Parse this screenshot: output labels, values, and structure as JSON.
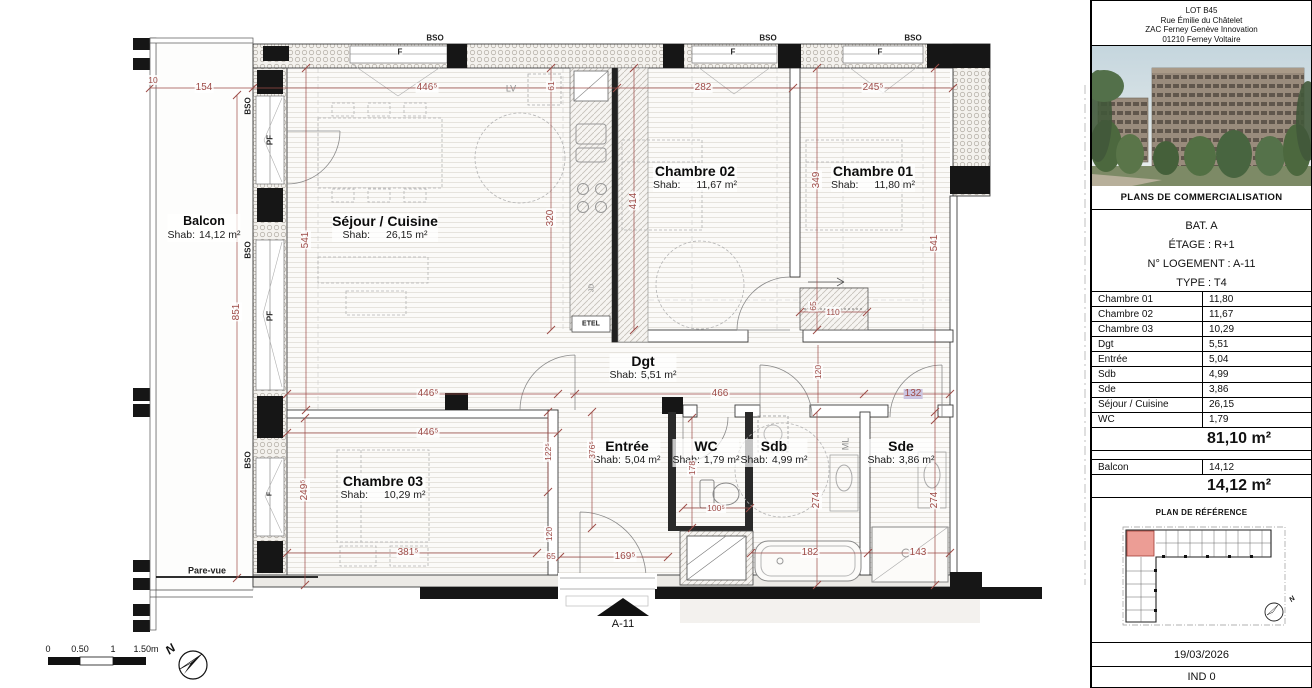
{
  "plan": {
    "shab_label": "Shab:",
    "rooms": [
      {
        "name": "Séjour / Cuisine",
        "area": "26,15 m²",
        "x": 385,
        "y": 214,
        "wide": true
      },
      {
        "name": "Chambre 02",
        "area": "11,67 m²",
        "x": 695,
        "y": 164,
        "wide": true
      },
      {
        "name": "Chambre 01",
        "area": "11,80 m²",
        "x": 873,
        "y": 164,
        "wide": true
      },
      {
        "name": "Chambre 03",
        "area": "10,29 m²",
        "x": 383,
        "y": 474,
        "wide": true
      },
      {
        "name": "Dgt",
        "area": "5,51 m²",
        "x": 643,
        "y": 354
      },
      {
        "name": "Entrée",
        "area": "5,04 m²",
        "x": 627,
        "y": 439
      },
      {
        "name": "WC",
        "area": "1,79 m²",
        "x": 706,
        "y": 439
      },
      {
        "name": "Sdb",
        "area": "4,99 m²",
        "x": 774,
        "y": 439
      },
      {
        "name": "Sde",
        "area": "3,86 m²",
        "x": 901,
        "y": 439
      },
      {
        "name": "Balcon",
        "area": "14,12 m²",
        "x": 204,
        "y": 214,
        "small": true
      }
    ],
    "dimensions": [
      {
        "t": "10",
        "x": 153,
        "y": 80,
        "s": 1
      },
      {
        "t": "154",
        "x": 204,
        "y": 88
      },
      {
        "t": "446⁵",
        "x": 427,
        "y": 88
      },
      {
        "t": "282",
        "x": 703,
        "y": 88
      },
      {
        "t": "245⁵",
        "x": 873,
        "y": 88
      },
      {
        "t": "851",
        "x": 237,
        "y": 312,
        "v": 1
      },
      {
        "t": "541",
        "x": 306,
        "y": 240,
        "v": 1
      },
      {
        "t": "541",
        "x": 935,
        "y": 243,
        "v": 1
      },
      {
        "t": "61",
        "x": 551,
        "y": 86,
        "v": 1,
        "s": 1
      },
      {
        "t": "320",
        "x": 551,
        "y": 218,
        "v": 1
      },
      {
        "t": "414",
        "x": 634,
        "y": 201,
        "v": 1
      },
      {
        "t": "349",
        "x": 817,
        "y": 180,
        "v": 1
      },
      {
        "t": "446⁵",
        "x": 428,
        "y": 394
      },
      {
        "t": "466",
        "x": 720,
        "y": 394
      },
      {
        "t": "132",
        "x": 913,
        "y": 394,
        "hl": 1
      },
      {
        "t": "446⁵",
        "x": 428,
        "y": 433
      },
      {
        "t": "122⁵",
        "x": 548,
        "y": 452,
        "v": 1,
        "s": 1
      },
      {
        "t": "376⁵",
        "x": 592,
        "y": 450,
        "v": 1,
        "s": 1
      },
      {
        "t": "178",
        "x": 692,
        "y": 468,
        "v": 1,
        "s": 1
      },
      {
        "t": "100⁵",
        "x": 716,
        "y": 508,
        "s": 1
      },
      {
        "t": "120",
        "x": 818,
        "y": 372,
        "v": 1,
        "s": 1
      },
      {
        "t": "110",
        "x": 833,
        "y": 312,
        "s": 1
      },
      {
        "t": "65",
        "x": 813,
        "y": 306,
        "v": 1,
        "s": 1
      },
      {
        "t": "274",
        "x": 817,
        "y": 500,
        "v": 1
      },
      {
        "t": "274",
        "x": 935,
        "y": 500,
        "v": 1
      },
      {
        "t": "120",
        "x": 549,
        "y": 534,
        "v": 1,
        "s": 1
      },
      {
        "t": "65",
        "x": 551,
        "y": 556,
        "s": 1
      },
      {
        "t": "169⁵",
        "x": 625,
        "y": 557
      },
      {
        "t": "182",
        "x": 810,
        "y": 553
      },
      {
        "t": "143",
        "x": 918,
        "y": 553
      },
      {
        "t": "381⁵",
        "x": 408,
        "y": 553
      },
      {
        "t": "249⁵",
        "x": 305,
        "y": 490,
        "v": 1
      }
    ],
    "annotations": [
      {
        "t": "BSO",
        "x": 435,
        "y": 38
      },
      {
        "t": "BSO",
        "x": 768,
        "y": 38
      },
      {
        "t": "BSO",
        "x": 913,
        "y": 38
      },
      {
        "t": "BSO",
        "x": 248,
        "y": 106,
        "v": 1
      },
      {
        "t": "BSO",
        "x": 248,
        "y": 250,
        "v": 1
      },
      {
        "t": "BSO",
        "x": 248,
        "y": 460,
        "v": 1
      },
      {
        "t": "F",
        "x": 400,
        "y": 52
      },
      {
        "t": "F",
        "x": 733,
        "y": 52
      },
      {
        "t": "F",
        "x": 880,
        "y": 52
      },
      {
        "t": "PF",
        "x": 270,
        "y": 140,
        "v": 1
      },
      {
        "t": "PF",
        "x": 270,
        "y": 316,
        "v": 1
      },
      {
        "t": "F",
        "x": 270,
        "y": 494,
        "v": 1,
        "s": 1
      },
      {
        "t": "LV",
        "x": 511,
        "y": 89,
        "gray": 1
      },
      {
        "t": "ETEL",
        "x": 591,
        "y": 324,
        "s": 1
      },
      {
        "t": "JD",
        "x": 592,
        "y": 288,
        "v": 1,
        "gray": 1,
        "s": 1
      },
      {
        "t": "ML",
        "x": 846,
        "y": 444,
        "v": 1,
        "gray": 1
      },
      {
        "t": "Pare-vue",
        "x": 207,
        "y": 571,
        "b": 1
      }
    ],
    "entry_marker": "A-11",
    "compass_label": "N",
    "scale_bar": {
      "labels": [
        {
          "t": "0",
          "x": 48
        },
        {
          "t": "0.50",
          "x": 80
        },
        {
          "t": "1",
          "x": 113
        },
        {
          "t": "1.50m",
          "x": 146
        }
      ]
    },
    "colors": {
      "dimension": "#9d4b47",
      "wall": "#161616",
      "highlight": "#cbc4e0",
      "ref_unit": "#ec9d95"
    }
  },
  "sidebar": {
    "header": {
      "line1": "LOT B45",
      "line2": "Rue Émilie du Châtelet",
      "line3": "ZAC Ferney Genève Innovation",
      "line4": "01210 Ferney Voltaire"
    },
    "caption": "PLANS DE COMMERCIALISATION",
    "info": {
      "bat": "BAT. A",
      "etage": "ÉTAGE : R+1",
      "logement": "N° LOGEMENT : A-11",
      "type": "TYPE : T4"
    },
    "rooms_table": {
      "rows": [
        [
          "Chambre 01",
          "11,80"
        ],
        [
          "Chambre 02",
          "11,67"
        ],
        [
          "Chambre 03",
          "10,29"
        ],
        [
          "Dgt",
          "5,51"
        ],
        [
          "Entrée",
          "5,04"
        ],
        [
          "Sdb",
          "4,99"
        ],
        [
          "Sde",
          "3,86"
        ],
        [
          "Séjour / Cuisine",
          "26,15"
        ],
        [
          "WC",
          "1,79"
        ]
      ]
    },
    "total_area": "81,10 m²",
    "balcon_row": {
      "label": "Balcon",
      "value": "14,12"
    },
    "balcon_total": "14,12 m²",
    "ref_plan_title": "PLAN DE RÉFÉRENCE",
    "ref_compass_label": "N",
    "date": "19/03/2026",
    "ind": "IND 0"
  }
}
